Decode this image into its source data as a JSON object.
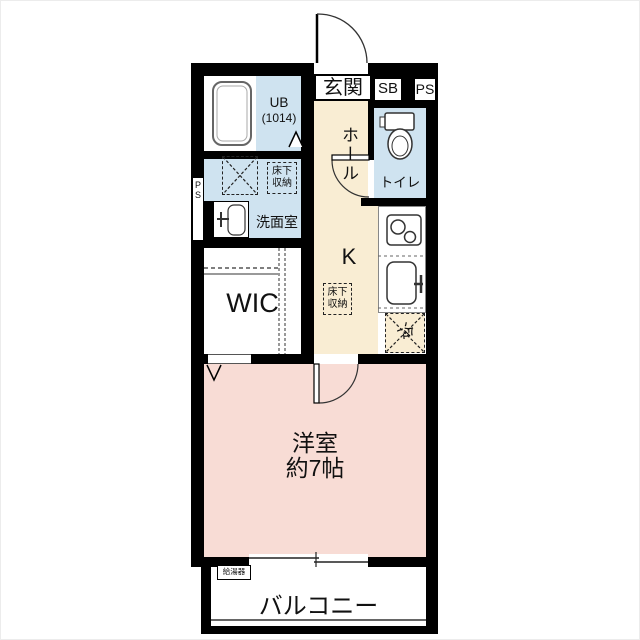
{
  "plan": {
    "type": "japanese-apartment-floor-plan",
    "colors": {
      "wall": "#000000",
      "wet_area_blue": "#cfe3f0",
      "hall_kitchen_cream": "#f9edd3",
      "western_room_pink": "#f8dcd5",
      "fixture_line": "#333333"
    },
    "labels": {
      "entrance": "玄関",
      "shoe_box": "SB",
      "pipe_space_top": "PS",
      "pipe_space_left_l1": "P",
      "pipe_space_left_l2": "S",
      "unit_bath_l1": "UB",
      "unit_bath_l2": "(1014)",
      "hall": "ホール",
      "toilet": "トイレ",
      "underfloor_storage_l1": "床下",
      "underfloor_storage_l2": "収納",
      "washroom": "洗面室",
      "walk_in_closet": "WIC",
      "kitchen": "K",
      "refrigerator": "冷",
      "western_room_l1": "洋室",
      "western_room_l2": "約7帖",
      "water_heater": "給湯器",
      "balcony": "バルコニー"
    }
  }
}
